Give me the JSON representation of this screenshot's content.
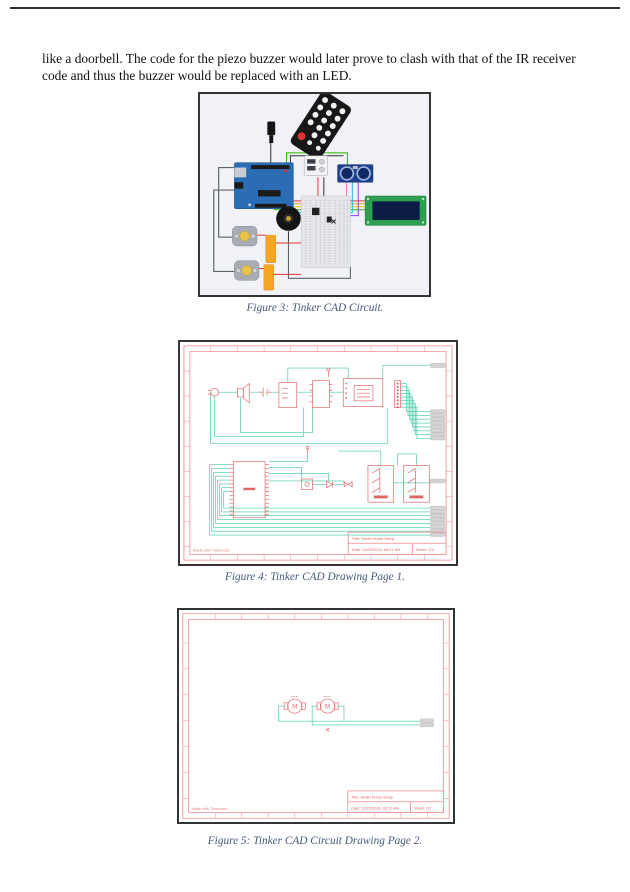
{
  "document": {
    "paragraph": "like a doorbell. The code for the piezo buzzer would later prove to clash with that of the IR receiver code and thus the buzzer would be replaced with an LED.",
    "figures": {
      "fig3": {
        "caption": "Figure 3: Tinker  CAD Circuit.",
        "description": "Tinkercad circuit build",
        "components": [
          "IR remote",
          "Arduino Uno",
          "9V power plug",
          "power supply",
          "ultrasonic sensor",
          "LCD display",
          "breadboard",
          "piezo buzzer",
          "DC motor 1",
          "DC motor 2",
          "H-bridge 1",
          "H-bridge 2"
        ]
      },
      "fig4": {
        "caption": "Figure 4: Tinker  CAD Drawing Page 1.",
        "title_block": {
          "title": "Title:   Smart Home Setup",
          "date": "Date:   10/22/2024, 06:11 AM",
          "sheet": "Sheet:   1/2"
        },
        "watermark": "Made with Tinkercad"
      },
      "fig5": {
        "caption": "Figure 5: Tinker CAD Circuit Drawing Page 2.",
        "title_block": {
          "title": "Title:   Smart Home Setup",
          "date": "Date:   10/22/2024, 06:11 AM",
          "sheet": "Sheet:   2/2"
        },
        "watermark": "Made with Tinkercad",
        "motor_labels": [
          "M",
          "M"
        ]
      }
    },
    "colors": {
      "caption_text": "#44597c",
      "schematic_frame_red": "#f08a8a",
      "schematic_component_red": "#e06666",
      "wire_teal": "#3fc9a5",
      "connector_stub_gray": "#d4d4d4",
      "arduino_blue": "#2a6db5",
      "lcd_green": "#2e9e4f",
      "figure3_background": "#f0f2f7"
    }
  }
}
